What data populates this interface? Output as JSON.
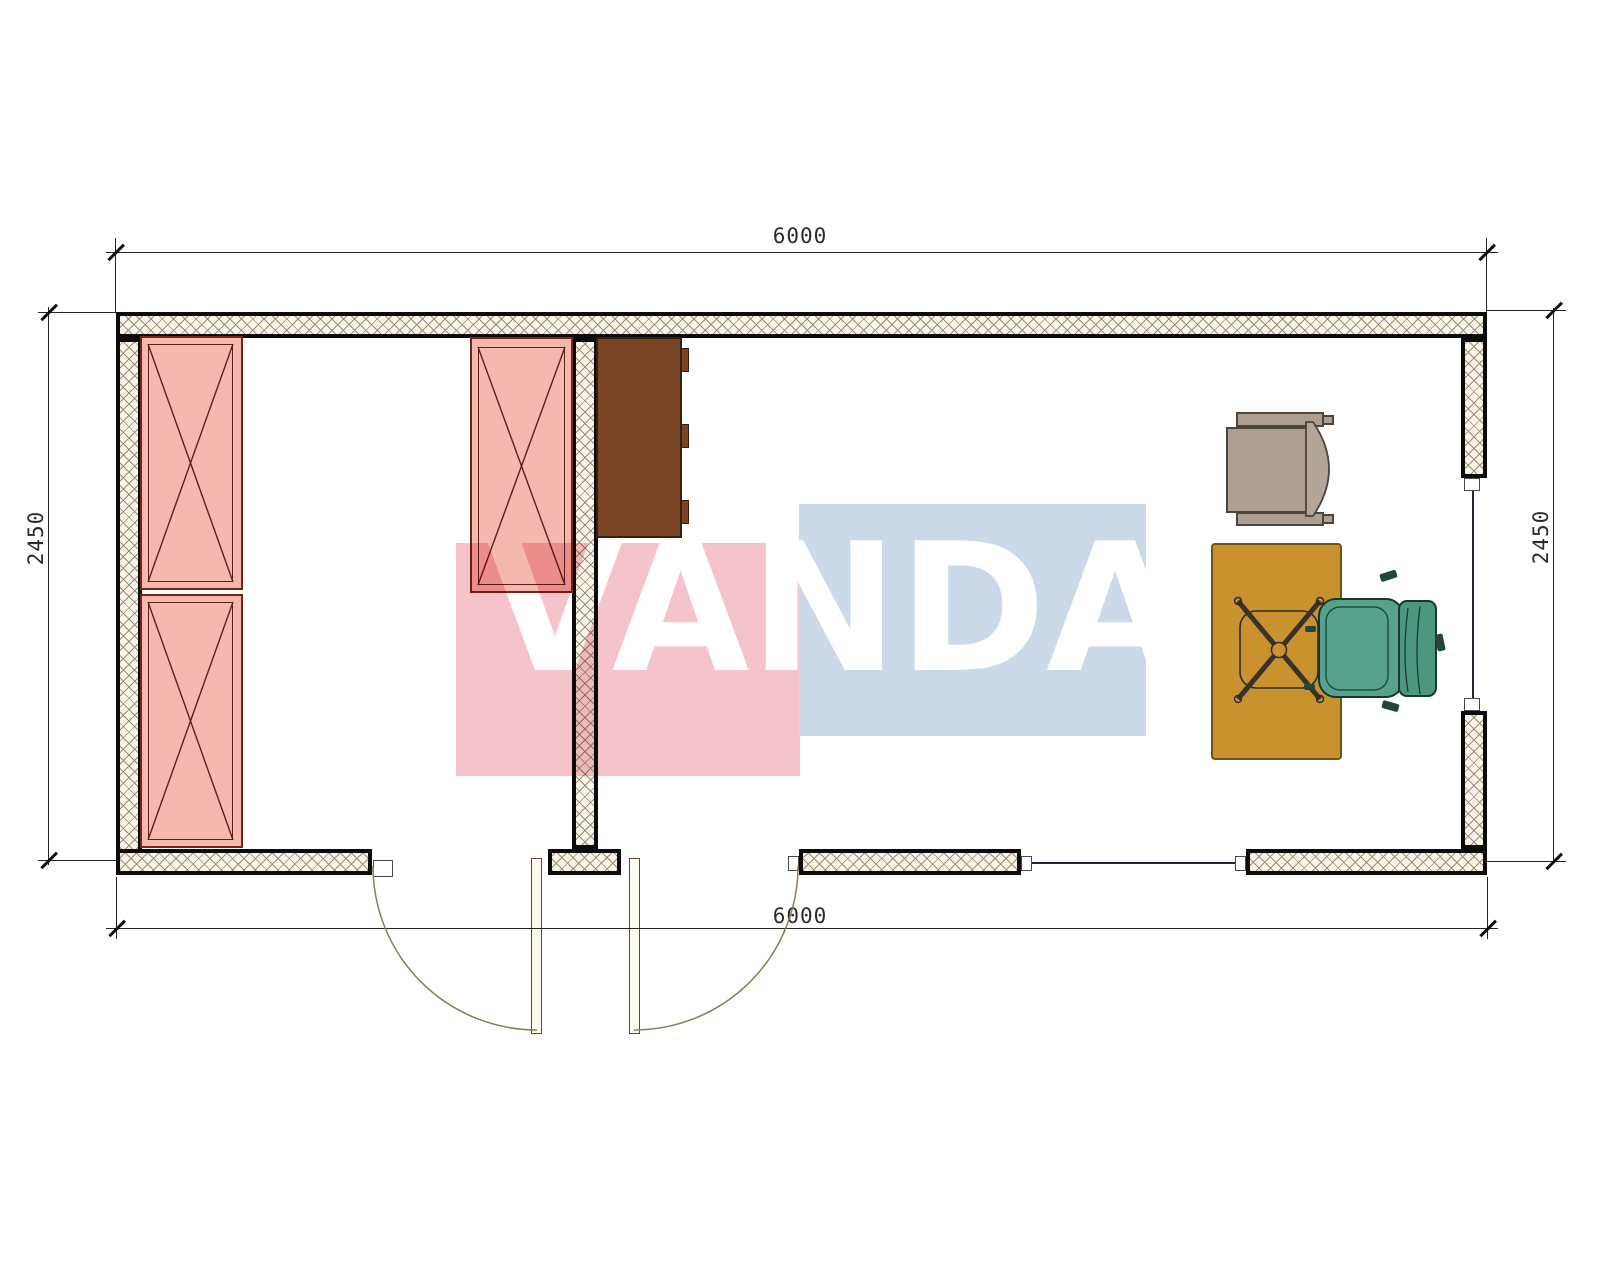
{
  "watermark": {
    "text": "VANDA",
    "pink_color": "#f5c3cb",
    "blue_color": "#ccd9e9"
  },
  "dimensions": {
    "top": "6000",
    "bottom": "6000",
    "left": "2450",
    "right": "2450"
  },
  "plan": {
    "walls": {
      "hatch_line_color": "#9a8f74",
      "fill_color": "#f8f4e9",
      "face_color": "#0c0c0c"
    },
    "furniture": [
      {
        "name": "wardrobe-left-upper",
        "symbol": "crossed-rectangle"
      },
      {
        "name": "wardrobe-left-lower",
        "symbol": "crossed-rectangle"
      },
      {
        "name": "wardrobe-partition",
        "symbol": "crossed-rectangle"
      },
      {
        "name": "cabinet",
        "color": "#7a4527"
      },
      {
        "name": "desk",
        "color": "#c9922f"
      },
      {
        "name": "armchair",
        "color": "#ac9e92"
      },
      {
        "name": "task-chair-base",
        "symbol": "swivel-cross"
      },
      {
        "name": "executive-chair",
        "color": "#58a18c"
      }
    ],
    "openings": [
      {
        "name": "entrance-door-left",
        "swing": "outward"
      },
      {
        "name": "entrance-door-right",
        "swing": "outward"
      },
      {
        "name": "window-bottom"
      },
      {
        "name": "window-right"
      }
    ]
  }
}
